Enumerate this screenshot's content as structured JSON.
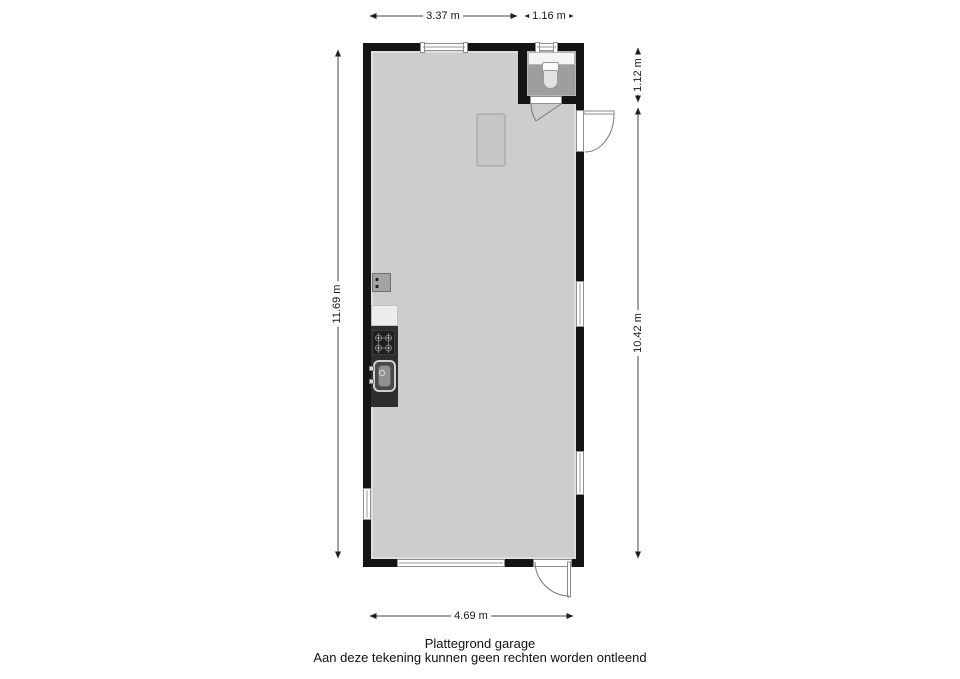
{
  "title": "Plattegrond garage",
  "disclaimer": "Aan deze tekening kunnen geen rechten worden ontleend",
  "dims": {
    "top_left": "3.37 m",
    "top_right": "1.16 m",
    "right_toilet": "1.12 m",
    "right_main": "10.42 m",
    "left": "11.69 m",
    "bottom": "4.69 m"
  },
  "colors": {
    "wall": "#141414",
    "garage_floor": "#cdcdcd",
    "toilet_floor": "#9e9e9e",
    "counter": "#2e2e2e",
    "skylight": "#c6c6c6",
    "dimension_text": "#1a1a1a"
  }
}
